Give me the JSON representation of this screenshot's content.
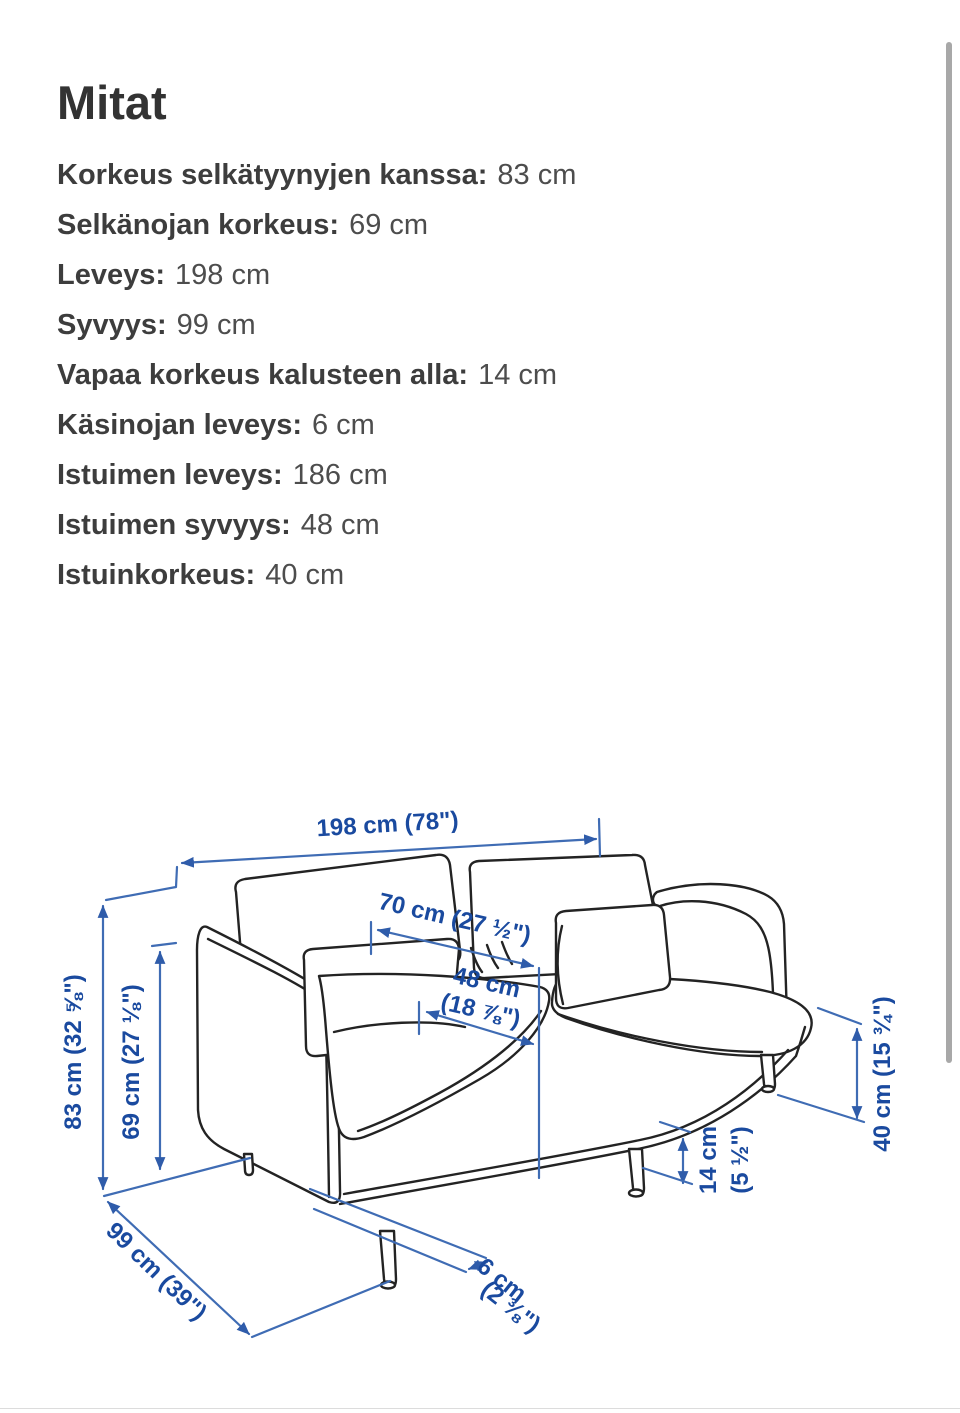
{
  "page": {
    "title": "Mitat"
  },
  "specs": [
    {
      "label": "Korkeus selkätyynyjen kanssa:",
      "value": "83 cm"
    },
    {
      "label": "Selkänojan korkeus:",
      "value": "69 cm"
    },
    {
      "label": "Leveys:",
      "value": "198 cm"
    },
    {
      "label": "Syvyys:",
      "value": "99 cm"
    },
    {
      "label": "Vapaa korkeus kalusteen alla:",
      "value": "14 cm"
    },
    {
      "label": "Käsinojan leveys:",
      "value": "6 cm"
    },
    {
      "label": "Istuimen leveys:",
      "value": "186 cm"
    },
    {
      "label": "Istuimen syvyys:",
      "value": "48 cm"
    },
    {
      "label": "Istuinkorkeus:",
      "value": "40 cm"
    }
  ],
  "diagram": {
    "labels": {
      "width": "198 cm (78\")",
      "back_cushion_width": "70 cm (27 ½\")",
      "seat_depth_1": "48 cm",
      "seat_depth_2": "(18 ⅞\")",
      "total_height": "83 cm (32 ⅝\")",
      "back_height": "69 cm (27 ⅛\")",
      "depth": "99 cm (39\")",
      "armrest_width_1": "6 cm",
      "armrest_width_2": "(2 ⅜\")",
      "under_clearance_1": "14 cm",
      "under_clearance_2": "(5 ½\")",
      "seat_height": "40 cm (15 ¾\")"
    },
    "colors": {
      "dimension_line": "#3f6cb4",
      "dimension_arrow": "#2f5caa",
      "dimension_text": "#1a4a9f",
      "sofa_outline": "#232323"
    }
  }
}
